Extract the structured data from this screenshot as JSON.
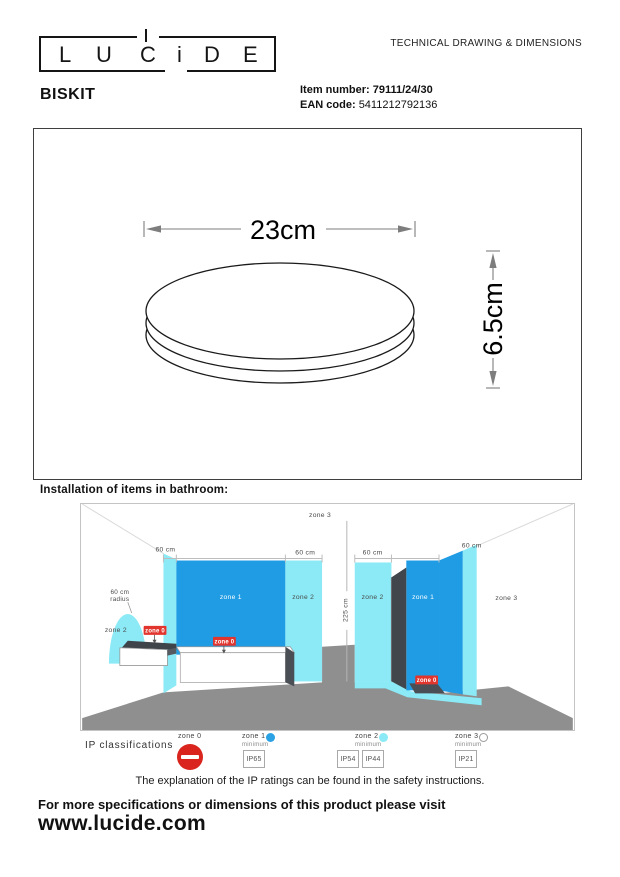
{
  "header": {
    "logo": {
      "letters": [
        "L",
        "U",
        "C",
        "i",
        "D",
        "E"
      ]
    },
    "doc_title": "TECHNICAL DRAWING & DIMENSIONS"
  },
  "product": {
    "name": "BISKIT",
    "item_number_label": "Item number:",
    "item_number": "79111/24/30",
    "ean_label": "EAN code:",
    "ean": "5411212792136"
  },
  "drawing": {
    "width": "23cm",
    "height": "6.5cm"
  },
  "bathroom": {
    "heading": "Installation of items in bathroom:",
    "zone0": "zone 0",
    "zone1": "zone 1",
    "zone2": "zone 2",
    "zone3": "zone 3",
    "dim_60": "60 cm",
    "dim_height": "225 cm",
    "radius_line1": "60 cm",
    "radius_line2": "radius"
  },
  "ip": {
    "title": "IP classifications",
    "zones": [
      {
        "name": "zone 0",
        "minimum": "",
        "ratings": []
      },
      {
        "name": "zone 1",
        "minimum": "minimum",
        "ratings": [
          "IP65"
        ]
      },
      {
        "name": "zone 2",
        "minimum": "minimum",
        "ratings": [
          "IP54",
          "IP44"
        ]
      },
      {
        "name": "zone 3",
        "minimum": "minimum",
        "ratings": [
          "IP21"
        ]
      }
    ],
    "note": "The explanation of the IP ratings can be found in the safety instructions."
  },
  "footer": {
    "line1": "For more specifications or dimensions of this product please visit",
    "website": "www.lucide.com"
  },
  "colors": {
    "zone_cyan": "#8BEAF6",
    "zone_blue": "#1F9CE4",
    "zone0_red": "#E2352D",
    "floor_gray": "#8F8F8F",
    "panel_dark": "#41464D"
  }
}
